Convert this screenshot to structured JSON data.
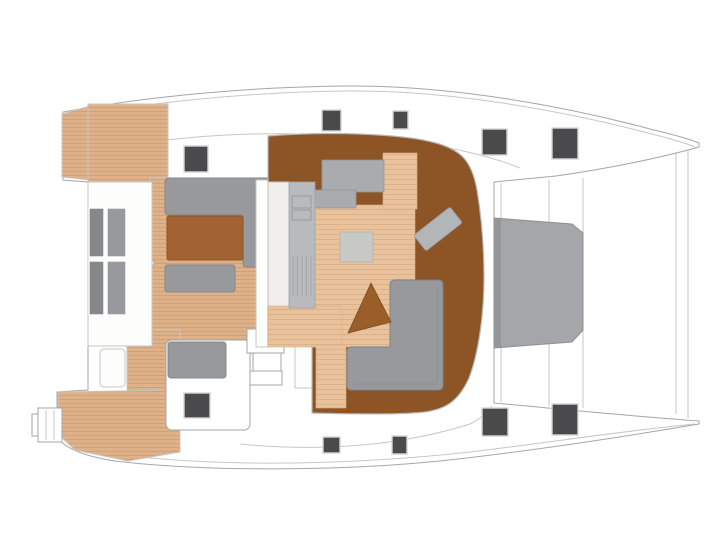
{
  "diagram": {
    "title": "Catamaran yacht deck plan, overhead view, bow pointing right",
    "view": "overhead",
    "bow_direction": "right"
  },
  "palette": {
    "bg": "#ffffff",
    "outline": "#a6a6a6",
    "outline-light": "#c6c6c4",
    "teak": "#dfb189",
    "teak-line": "#d0a078",
    "tan": "#e9c29c",
    "tan-line": "#dcb28a",
    "brown": "#8d5526",
    "brown-mid": "#9a5e2b",
    "table-brown": "#a26231",
    "furn-gray": "#98999c",
    "furn-gray-dark": "#85878a",
    "furn-gray-mid": "#a9abae",
    "counter-gray": "#b8bbbe",
    "tramp-gray": "#a4a6a9",
    "tramp-edge": "#8d8f92",
    "tramp-dark": "#94969a",
    "hatch": "#4a4a4c",
    "hatch-rim": "#d6d6d6"
  },
  "deck_hatches": {
    "port": [
      {
        "x": 184,
        "y": 146,
        "w": 24,
        "h": 26
      },
      {
        "x": 322,
        "y": 110,
        "w": 19,
        "h": 21
      },
      {
        "x": 393,
        "y": 111,
        "w": 15,
        "h": 18
      },
      {
        "x": 482,
        "y": 129,
        "w": 25,
        "h": 26
      },
      {
        "x": 552,
        "y": 128,
        "w": 26,
        "h": 31
      }
    ],
    "starboard": [
      {
        "x": 323,
        "y": 437,
        "w": 17,
        "h": 16
      },
      {
        "x": 392,
        "y": 436,
        "w": 15,
        "h": 18
      },
      {
        "x": 482,
        "y": 408,
        "w": 26,
        "h": 28
      },
      {
        "x": 552,
        "y": 404,
        "w": 26,
        "h": 31
      }
    ]
  },
  "helm": {
    "instrument_panel": {
      "x": 184,
      "y": 393,
      "w": 26,
      "h": 25
    }
  },
  "cockpit_bench_cushions": [
    {
      "x": 89,
      "y": 208,
      "w": 15,
      "h": 49,
      "shade": "dark"
    },
    {
      "x": 107,
      "y": 208,
      "w": 19,
      "h": 49,
      "shade": "mid"
    },
    {
      "x": 89,
      "y": 261,
      "w": 15,
      "h": 54,
      "shade": "dark"
    },
    {
      "x": 107,
      "y": 261,
      "w": 19,
      "h": 54,
      "shade": "mid"
    }
  ],
  "areas": [
    {
      "name": "port-hull",
      "label": "Port hull"
    },
    {
      "name": "starboard-hull",
      "label": "Starboard hull"
    },
    {
      "name": "aft-cockpit",
      "label": "Aft cockpit teak deck"
    },
    {
      "name": "transom-platform",
      "label": "Transom platform"
    },
    {
      "name": "swim-ladder",
      "label": "Swim ladder"
    },
    {
      "name": "cockpit-sofa",
      "label": "Cockpit L-sofa"
    },
    {
      "name": "cockpit-table",
      "label": "Cockpit table"
    },
    {
      "name": "cockpit-bench",
      "label": "Cockpit bench"
    },
    {
      "name": "helm-station",
      "label": "Helm station"
    },
    {
      "name": "saloon",
      "label": "Saloon"
    },
    {
      "name": "galley-counter",
      "label": "Galley counter"
    },
    {
      "name": "saloon-table",
      "label": "Saloon table"
    },
    {
      "name": "saloon-sofa",
      "label": "Saloon L-sofa"
    },
    {
      "name": "chaise-seat",
      "label": "Angled chaise seat"
    },
    {
      "name": "foredeck-trampoline",
      "label": "Foredeck trampoline"
    },
    {
      "name": "deck-hatches",
      "label": "Deck hatches"
    }
  ]
}
